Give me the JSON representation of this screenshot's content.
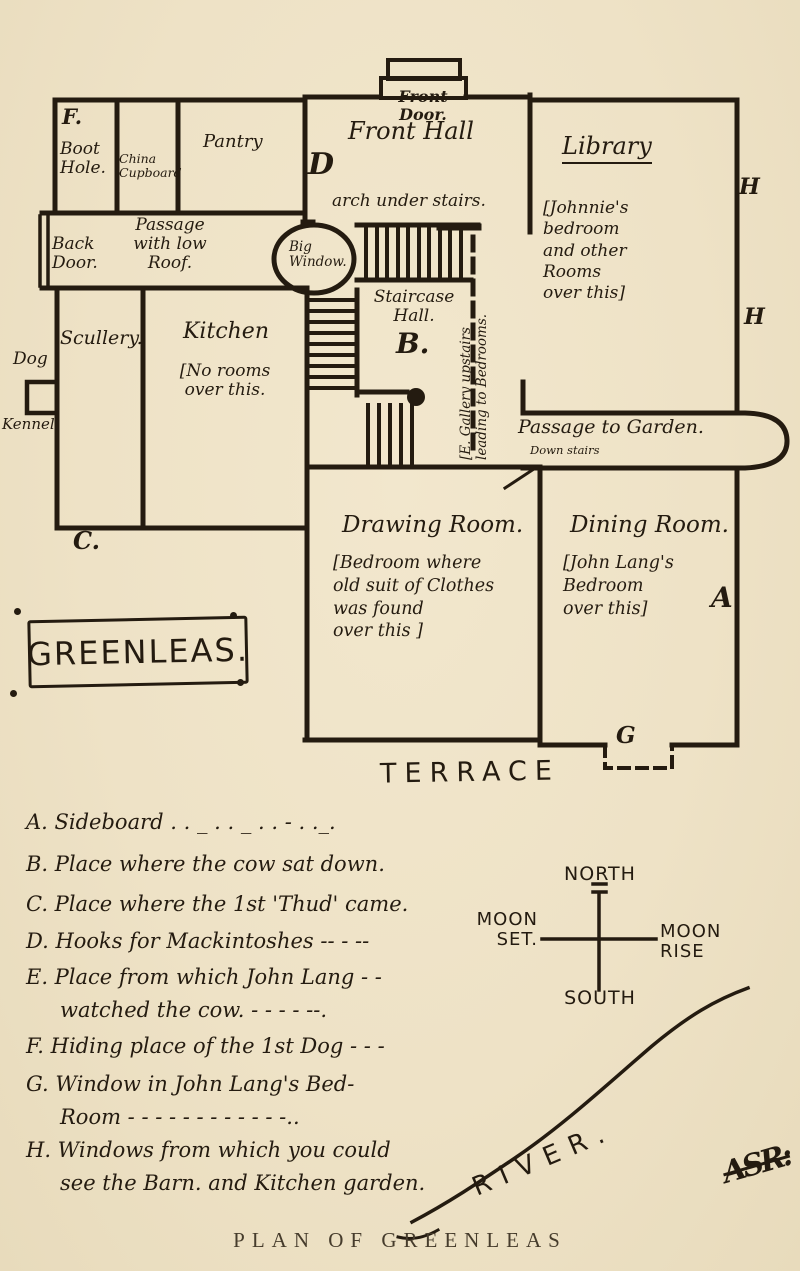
{
  "caption": "PLAN OF GREENLEAS",
  "colors": {
    "paper": "#eee2c6",
    "ink": "#241b10"
  },
  "plan": {
    "front_door": "Front\nDoor.",
    "front_hall": "Front Hall",
    "arch_note": "arch under stairs.",
    "marker_d": "D",
    "library": "Library",
    "library_note": "[Johnnie's\nbedroom\nand other\nRooms\nover this]",
    "marker_h_upper": "H",
    "marker_h_lower": "H",
    "marker_f": "F.",
    "boot_hole": "Boot\nHole.",
    "china_cupboard": "China\nCupboard",
    "pantry": "Pantry",
    "back_door": "Back\nDoor.",
    "passage_low_roof": "Passage\nwith low\nRoof.",
    "big_window": "Big\nWindow.",
    "staircase_hall": "Staircase\nHall.",
    "marker_b": "B.",
    "gallery_note": "[E. Gallery upstairs\nleading to Bedrooms.",
    "dog": "Dog",
    "kennel": "Kennel",
    "scullery": "Scullery.",
    "kitchen": "Kitchen",
    "kitchen_note": "[No rooms\nover this.",
    "marker_c": "C.",
    "house_name": "GREENLEAS.",
    "passage_garden": "Passage to Garden.",
    "down_stairs": "Down stairs",
    "drawing_room": "Drawing Room.",
    "drawing_note": "[Bedroom where\nold suit of Clothes\nwas found\nover this ]",
    "dining_room": "Dining Room.",
    "dining_note": "[John Lang's\nBedroom\nover this]",
    "marker_a": "A",
    "marker_g": "G",
    "terrace": "TERRACE"
  },
  "legend": {
    "items": [
      {
        "text": "A. Sideboard . . _ . . _ . . - . ._."
      },
      {
        "text": "B. Place where the cow sat down."
      },
      {
        "text": "C. Place where the 1st 'Thud' came."
      },
      {
        "text": "D. Hooks for Mackintoshes -- - --"
      },
      {
        "text": "E. Place from which John Lang - -\nwatched the cow. - - - - --."
      },
      {
        "text": "F. Hiding place of the 1st Dog - - -"
      },
      {
        "text": "G. Window in John Lang's Bed-\nRoom - - - - - - - - - - - -.."
      },
      {
        "text": "H. Windows from which you could\nsee the Barn. and Kitchen garden."
      }
    ]
  },
  "compass": {
    "north": "NORTH",
    "south": "SOUTH",
    "west": "MOON\nSET.",
    "east": "MOON\nRISE"
  },
  "river": {
    "label": "RIVER.",
    "signature": "ASR:"
  }
}
